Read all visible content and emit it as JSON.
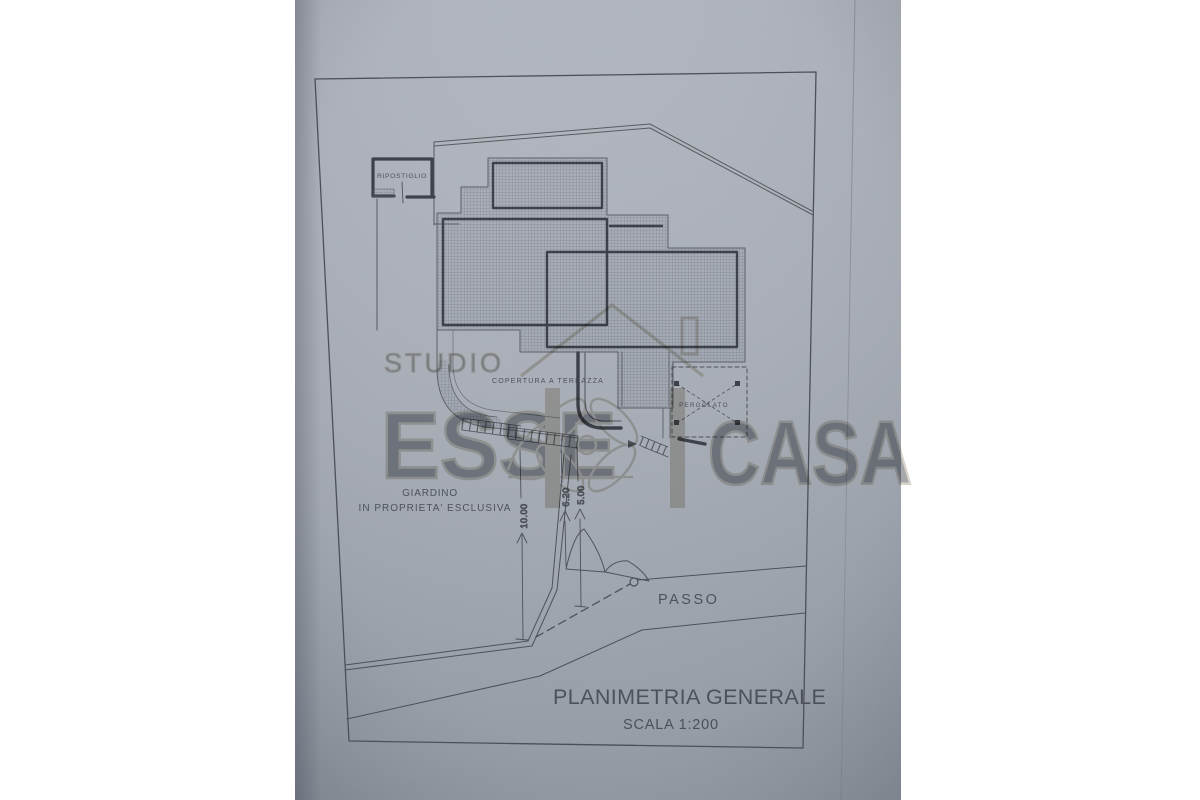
{
  "drawing": {
    "title": "PLANIMETRIA GENERALE",
    "scale_note": "SCALA  1:200",
    "rooms": {
      "ripostiglio": "RIPOSTIGLIO"
    },
    "areas": {
      "copertura_terrazza": "COPERTURA A TERRAZZA",
      "pergolato": "PERGOLATO",
      "giardino_line1": "GIARDINO",
      "giardino_line2": "IN PROPRIETA' ESCLUSIVA",
      "passo": "PASSO"
    },
    "dimensions": {
      "garden_depth": "10.00",
      "drive_left": "6.20",
      "drive_right": "5.00"
    },
    "colors": {
      "paper": "#a9aeb7",
      "ink": "#4b4f57",
      "wall": "#3a3e47",
      "watermark": "#b3aa93",
      "background": "#ffffff"
    }
  },
  "watermark": {
    "studio": "STUDIO",
    "esse": "ESSE",
    "casa": "CASA"
  }
}
